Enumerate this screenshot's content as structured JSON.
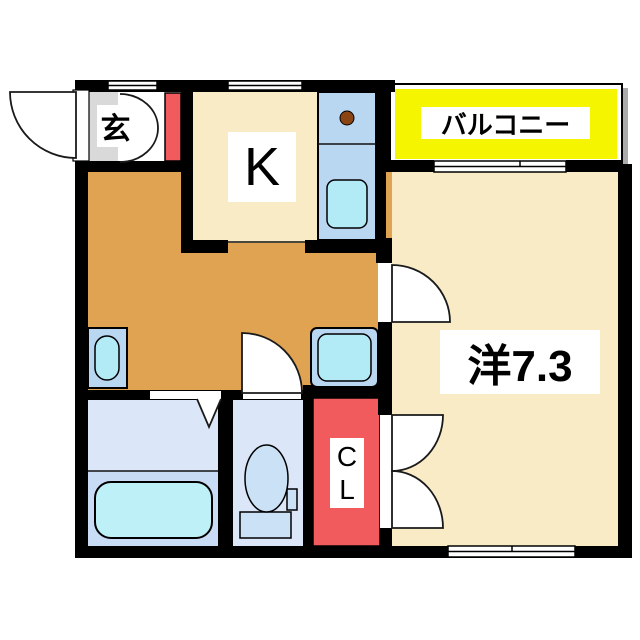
{
  "plan": {
    "type": "apartment-floor-plan",
    "labels": {
      "entrance": "玄",
      "kitchen": "K",
      "balcony": "バルコニー",
      "western_room": "洋7.3",
      "closet_line1": "C",
      "closet_line2": "L"
    }
  },
  "colors": {
    "wall": "#000000",
    "cream": "#FAEBC7",
    "orange": "#DFA351",
    "gray": "#D9D9D9",
    "red": "#F25B5E",
    "yellow": "#F5F500",
    "panel-blue": "#BAD7F2",
    "bath-upper": "#DBE7F8",
    "bath-lower": "#C8DCF5",
    "cyan": "#B2EBF5",
    "tub-cyan": "#BEF0F8",
    "toilet-blue": "#CBE1F6",
    "burner": "#8B4513",
    "shadow": "#ABABAB"
  }
}
